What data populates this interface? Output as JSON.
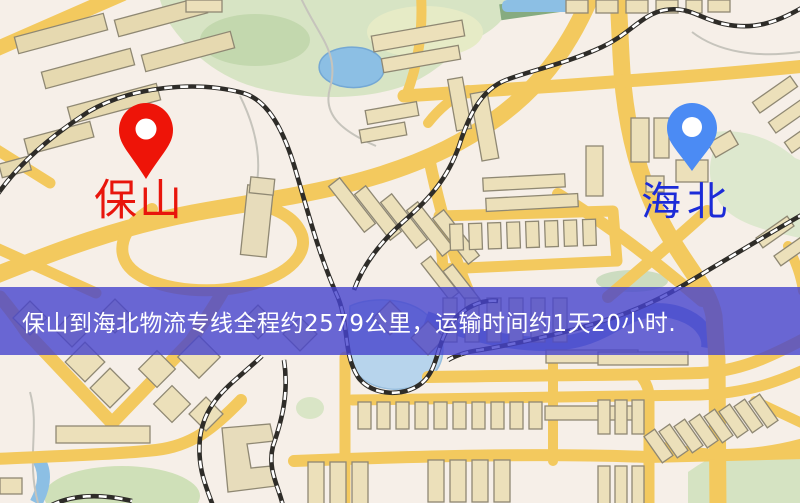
{
  "window": {
    "width": 800,
    "height": 503,
    "kind": "logistics-route-map"
  },
  "map": {
    "markers": [
      {
        "id": "origin",
        "label": "保山",
        "pin_color": "#ee1408",
        "label_color": "#e8150c",
        "pin_style": "red-map-pin"
      },
      {
        "id": "destination",
        "label": "海北",
        "pin_color": "#4b8bf4",
        "label_color": "#1c2bd8",
        "pin_style": "blue-map-pin"
      }
    ],
    "banner": {
      "text": "保山到海北物流专线全程约2579公里，运输时间约1天20小时.",
      "background_color": "rgba(70,68,205,0.80)",
      "text_color": "#ffffff"
    },
    "route": {
      "origin": "保山",
      "destination": "海北",
      "distance_text": "全程约2579公里",
      "duration_text": "运输时间约1天20小时"
    },
    "palette": {
      "background": "#f6efe8",
      "road": "#f3c95e",
      "building_fill": "#ece0ba",
      "building_stroke": "#8f8873",
      "park_green": "#d7e4c4",
      "water_blue": "#8cbfe4",
      "railway_black": "#2e2c28"
    }
  }
}
